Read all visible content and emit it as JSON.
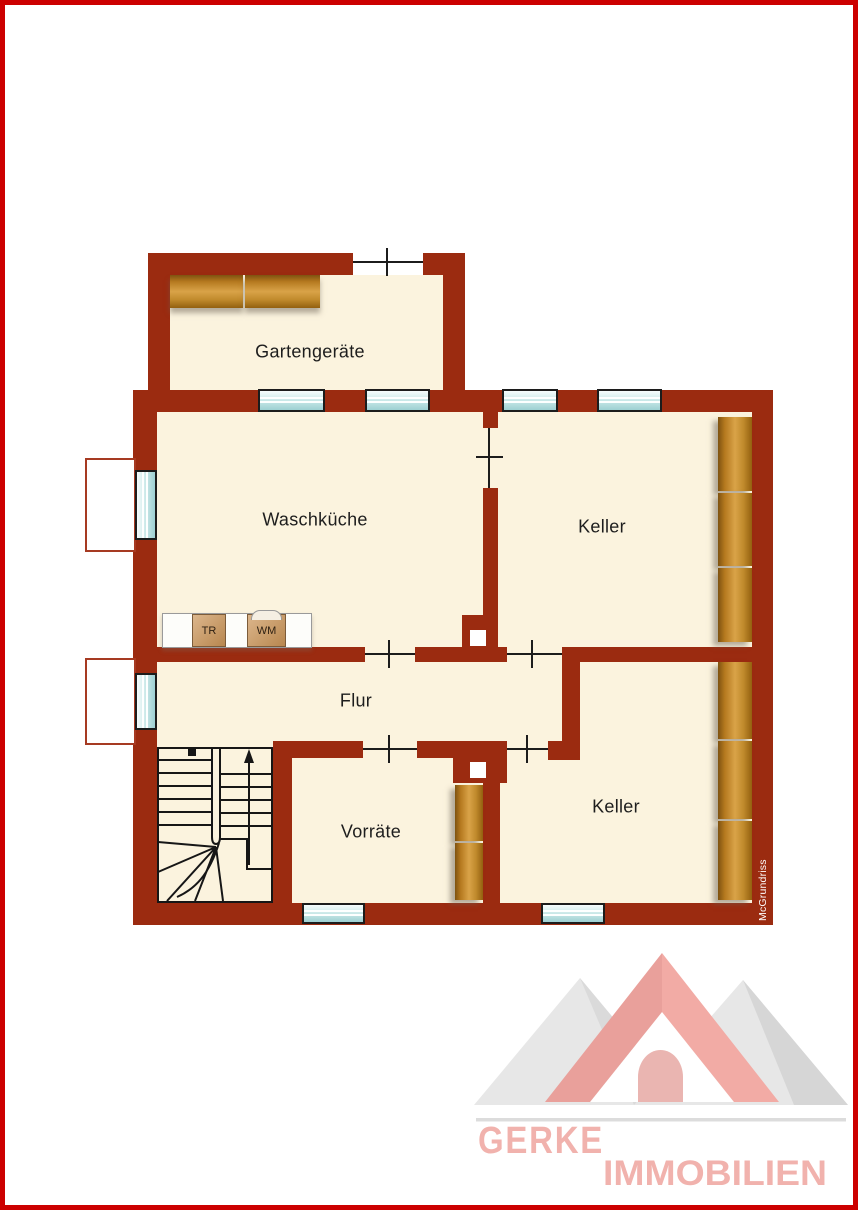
{
  "page": {
    "background": "#ffffff",
    "border_color": "#cc0000"
  },
  "plan": {
    "watermark": "McGrundriss",
    "colors": {
      "wall": "#9b2b10",
      "floor": "#fbf3de",
      "outline": "#1a1a1a",
      "window_glass": "#bfe1e2",
      "wood_light": "#d9a348",
      "wood_dark": "#8a5a12",
      "lightwell_border": "#a63a22"
    },
    "rooms": [
      {
        "id": "gartengeraete",
        "label": "Gartengeräte"
      },
      {
        "id": "waschkueche",
        "label": "Waschküche"
      },
      {
        "id": "keller-upper",
        "label": "Keller"
      },
      {
        "id": "flur",
        "label": "Flur"
      },
      {
        "id": "vorraete",
        "label": "Vorräte"
      },
      {
        "id": "keller-lower",
        "label": "Keller"
      }
    ],
    "appliances": [
      {
        "id": "dryer",
        "label": "TR"
      },
      {
        "id": "washing-machine",
        "label": "WM"
      }
    ]
  },
  "logo": {
    "line1": "GERKE",
    "line2": "IMMOBILIEN",
    "pink": "#f2aba5",
    "text_pink": "#f1b2ad",
    "gray": "#e7e7e7"
  }
}
